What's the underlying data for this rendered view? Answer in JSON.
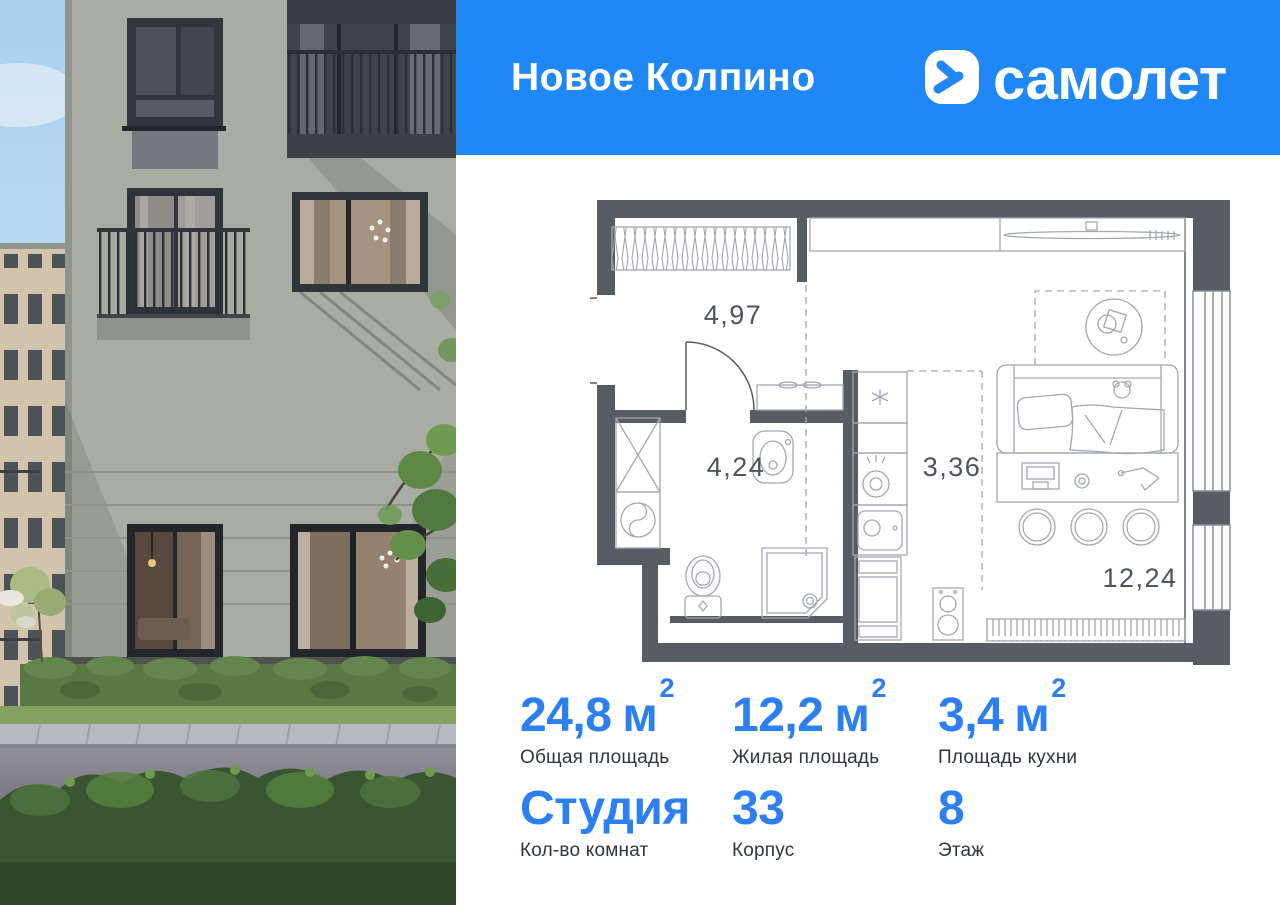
{
  "colors": {
    "banner_blue": "#1f87f6",
    "value_blue": "#2b7ff0",
    "wall_gray": "#575c65",
    "plan_line_gray": "#a3a8b0"
  },
  "banner": {
    "title": "Новое Колпино",
    "brand": "самолет"
  },
  "plan": {
    "rooms": [
      {
        "name": "hallway",
        "area": "4,97"
      },
      {
        "name": "bathroom",
        "area": "4,24"
      },
      {
        "name": "kitchen",
        "area": "3,36"
      },
      {
        "name": "living-room",
        "area": "12,24"
      }
    ]
  },
  "stats": {
    "row1": [
      {
        "value": "24,8",
        "unit": "м",
        "sup": "2",
        "label": "Общая площадь"
      },
      {
        "value": "12,2",
        "unit": "м",
        "sup": "2",
        "label": "Жилая площадь"
      },
      {
        "value": "3,4",
        "unit": "м",
        "sup": "2",
        "label": "Площадь кухни"
      }
    ],
    "row2": [
      {
        "value": "Студия",
        "label": "Кол-во комнат"
      },
      {
        "value": "33",
        "label": "Корпус"
      },
      {
        "value": "8",
        "label": "Этаж"
      }
    ]
  }
}
